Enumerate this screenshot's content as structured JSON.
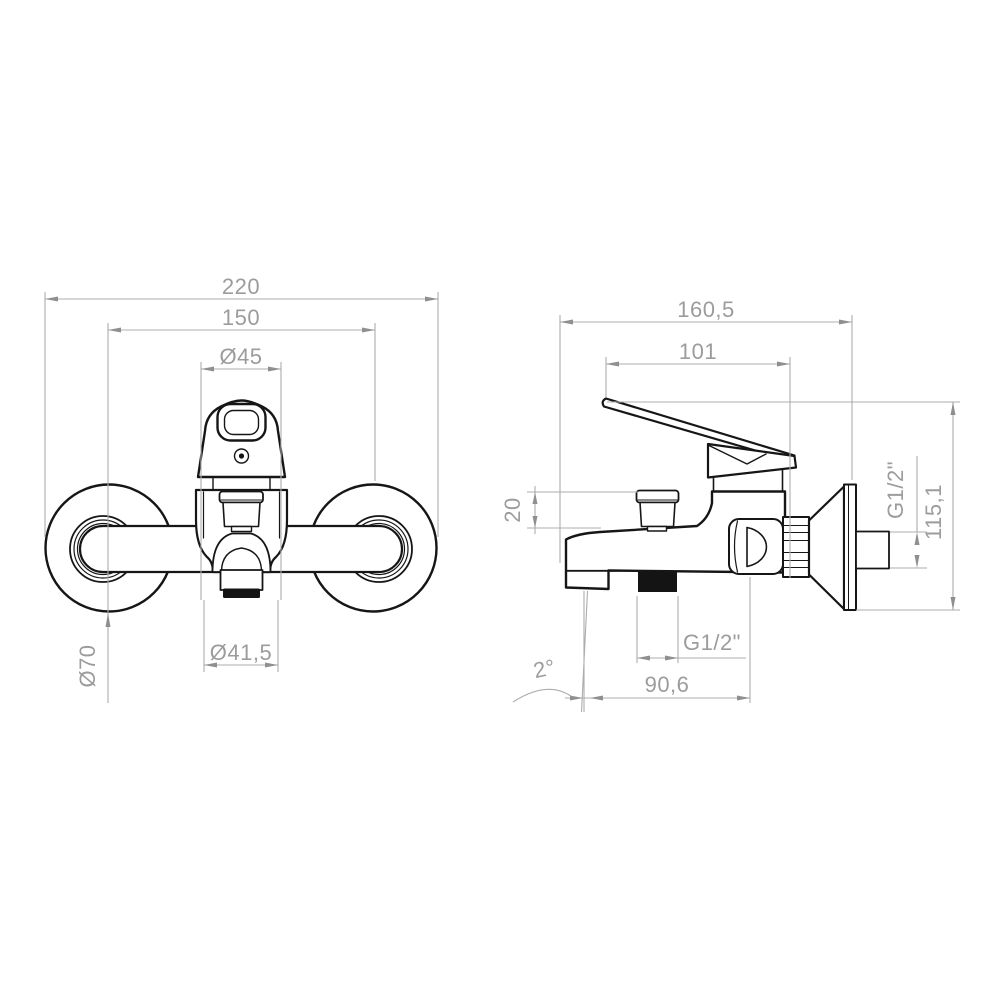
{
  "front_view": {
    "dims": {
      "overall_width": "220",
      "mounting_centers": "150",
      "handle_diameter": "Ø45",
      "outlet_diameter": "Ø41,5",
      "escutcheon_diameter": "Ø70"
    }
  },
  "side_view": {
    "dims": {
      "overall_depth": "160,5",
      "lever_projection": "101",
      "diverter_height": "20",
      "shower_outlet_thread": "G1/2\"",
      "spout_projection": "90,6",
      "spout_angle": "2°",
      "overall_height": "115,1",
      "wall_connection_thread": "G1/2\""
    }
  },
  "colors": {
    "outline": "#161616",
    "dimension": "#9c9c9c",
    "background": "#ffffff"
  }
}
